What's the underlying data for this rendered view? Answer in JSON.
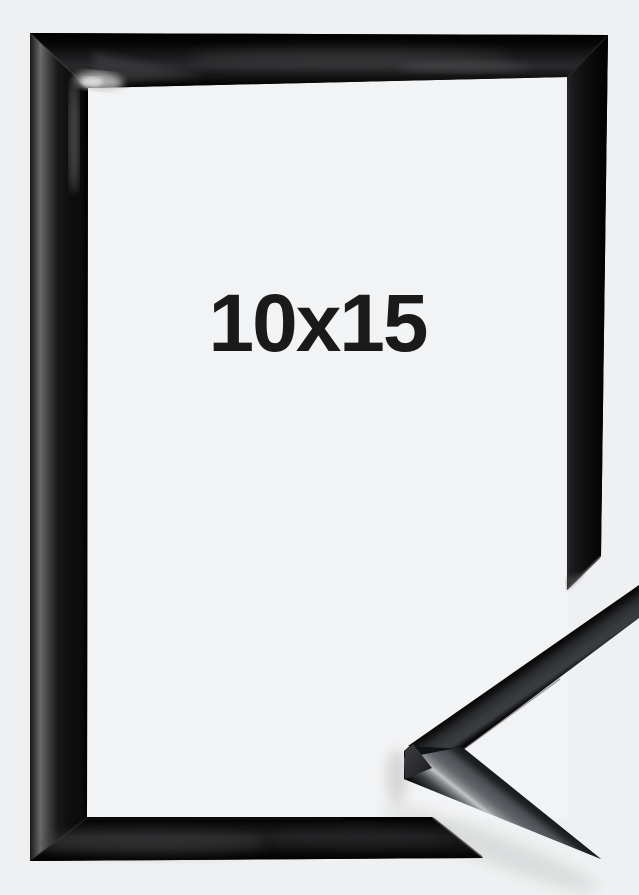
{
  "product": {
    "size_label": "10x15"
  },
  "colors": {
    "page_background": "#eef0f1",
    "frame_interior": "#f2f3f4",
    "frame_black": "#0a0a0a",
    "frame_sheen_gray": "#6a6b6d",
    "profile_face_gray": "#63676b",
    "profile_highlight": "#c2c4c6",
    "label_text": "#1a1a1a"
  }
}
